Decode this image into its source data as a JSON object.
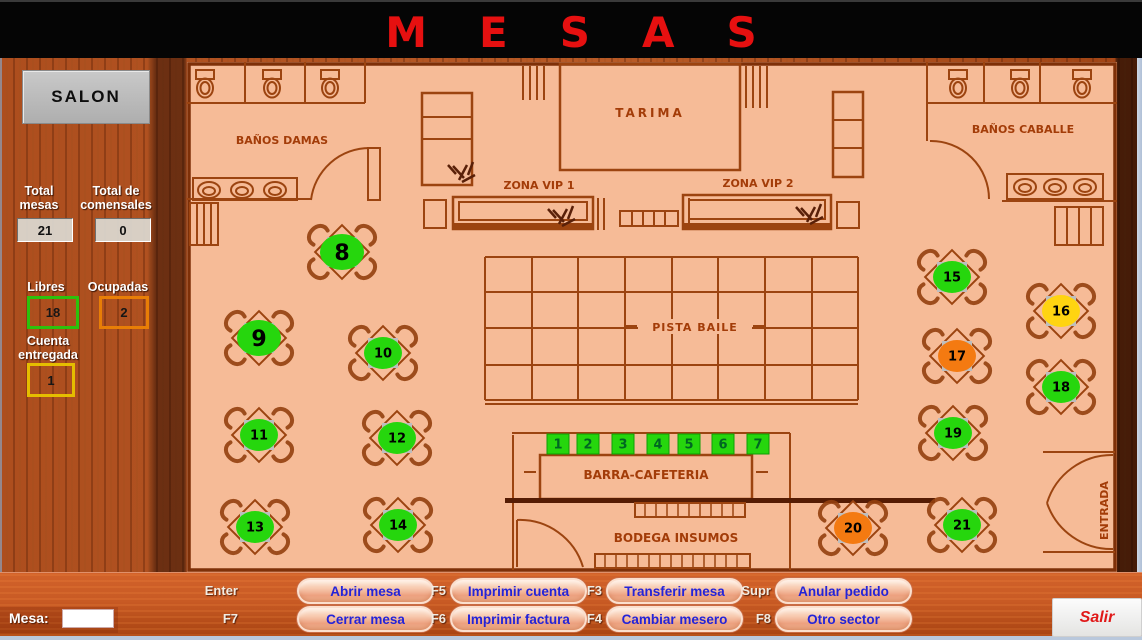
{
  "title": "MESAS",
  "sidebar": {
    "salon_label": "SALON",
    "total_mesas_label": "Total mesas",
    "total_mesas_value": "21",
    "total_comensales_label": "Total de comensales",
    "total_comensales_value": "0",
    "libres_label": "Libres",
    "libres_value": "18",
    "ocupadas_label": "Ocupadas",
    "ocupadas_value": "2",
    "cuenta_label": "Cuenta entregada",
    "cuenta_value": "1"
  },
  "status_colors": {
    "libre": "#26d60d",
    "ocupada": "#f47a11",
    "cuenta_entregada": "#ffd411"
  },
  "plan_labels": {
    "banos_damas": "BAÑOS DAMAS",
    "tarima": "TARIMA",
    "zona_vip_1": "ZONA VIP 1",
    "zona_vip_2": "ZONA VIP 2",
    "banos_caballe": "BAÑOS CABALLE",
    "pista_baile": "PISTA BAILE",
    "barra_cafeteria": "BARRA-CAFETERIA",
    "bodega_insumos": "BODEGA INSUMOS",
    "entrada": "ENTRADA"
  },
  "tables": [
    {
      "number": "8",
      "status": "libre"
    },
    {
      "number": "9",
      "status": "libre"
    },
    {
      "number": "10",
      "status": "libre"
    },
    {
      "number": "11",
      "status": "libre"
    },
    {
      "number": "12",
      "status": "libre"
    },
    {
      "number": "13",
      "status": "libre"
    },
    {
      "number": "14",
      "status": "libre"
    },
    {
      "number": "15",
      "status": "libre"
    },
    {
      "number": "16",
      "status": "cuenta_entregada"
    },
    {
      "number": "17",
      "status": "ocupada"
    },
    {
      "number": "18",
      "status": "libre"
    },
    {
      "number": "19",
      "status": "libre"
    },
    {
      "number": "20",
      "status": "ocupada"
    },
    {
      "number": "21",
      "status": "libre"
    }
  ],
  "bar_seats": [
    {
      "number": "1",
      "status": "libre"
    },
    {
      "number": "2",
      "status": "libre"
    },
    {
      "number": "3",
      "status": "libre"
    },
    {
      "number": "4",
      "status": "libre"
    },
    {
      "number": "5",
      "status": "libre"
    },
    {
      "number": "6",
      "status": "libre"
    },
    {
      "number": "7",
      "status": "libre"
    }
  ],
  "footer": {
    "mesa_label": "Mesa:",
    "mesa_value": "",
    "buttons": [
      {
        "key": "Enter",
        "label": "Abrir mesa",
        "name": "abrir-mesa"
      },
      {
        "key": "F5",
        "label": "Imprimir cuenta",
        "name": "imprimir-cuenta"
      },
      {
        "key": "F3",
        "label": "Transferir mesa",
        "name": "transferir-mesa"
      },
      {
        "key": "Supr",
        "label": "Anular pedido",
        "name": "anular-pedido"
      },
      {
        "key": "F7",
        "label": "Cerrar mesa",
        "name": "cerrar-mesa"
      },
      {
        "key": "F6",
        "label": "Imprimir factura",
        "name": "imprimir-factura"
      },
      {
        "key": "F4",
        "label": "Cambiar mesero",
        "name": "cambiar-mesero"
      },
      {
        "key": "F8",
        "label": "Otro sector",
        "name": "otro-sector"
      }
    ],
    "salir_label": "Salir"
  }
}
